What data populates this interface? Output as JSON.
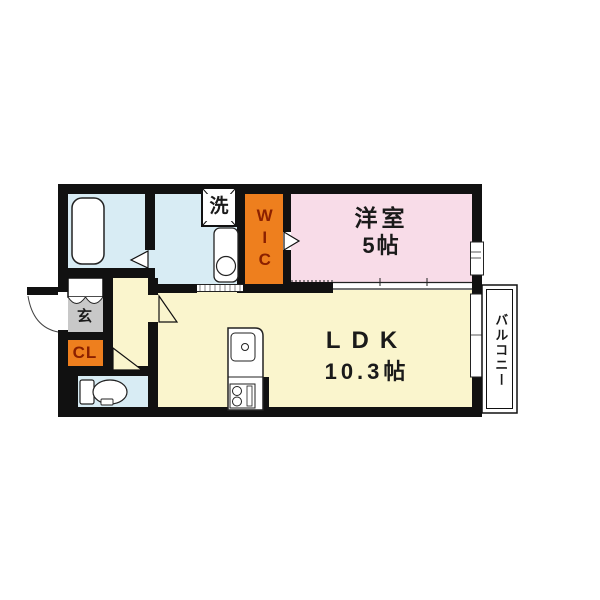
{
  "floorplan": {
    "rooms": {
      "bedroom": {
        "name": "洋室",
        "size": "5帖"
      },
      "ldk": {
        "name": "LDK",
        "size": "10.3帖"
      },
      "wic": {
        "label": "WIC"
      },
      "closet": {
        "label": "CL"
      },
      "entrance": {
        "label": "玄"
      },
      "laundry": {
        "label": "洗"
      },
      "balcony": {
        "label": "バルコニー"
      }
    },
    "colors": {
      "bedroom_pink": "#f8dce8",
      "ldk_yellow": "#faf5cd",
      "wet_area_blue": "#d8ecf4",
      "storage_orange": "#ee7f1e",
      "entrance_gray": "#c8c8c8",
      "wall_black": "#111111",
      "storage_text_maroon": "#8b2000"
    }
  }
}
